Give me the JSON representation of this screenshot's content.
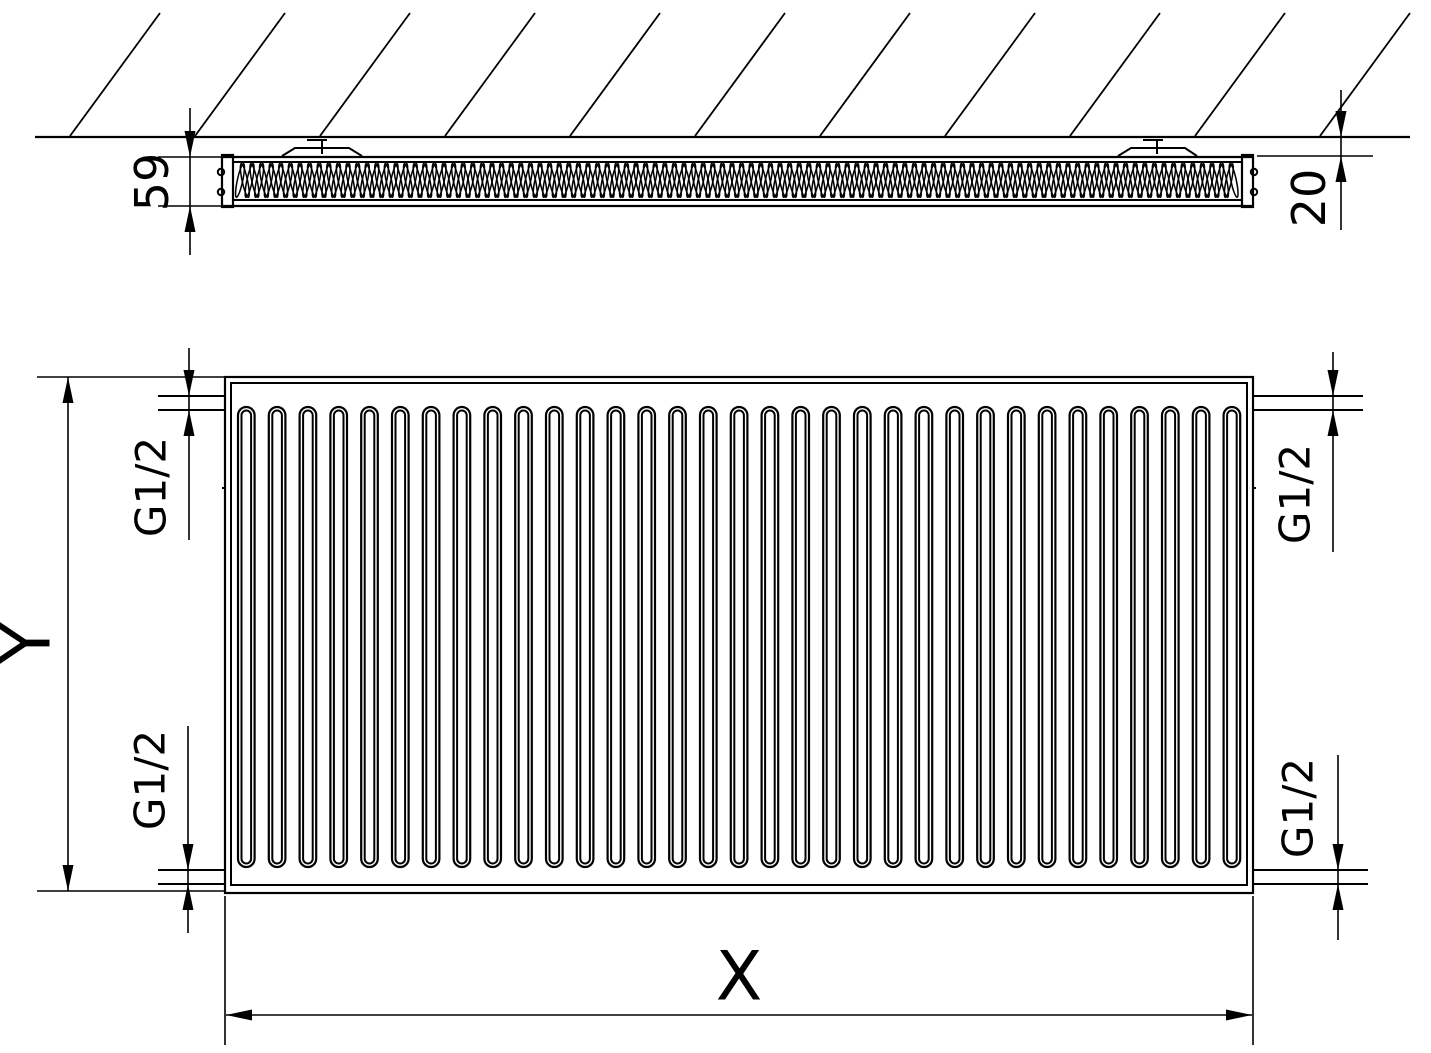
{
  "drawing": {
    "colors": {
      "line": "#000000",
      "background": "#ffffff"
    },
    "top_view": {
      "depth_label": "59",
      "wall_gap_label": "20"
    },
    "front_view": {
      "height_label": "Y",
      "width_label": "X",
      "connections": {
        "top_left": "G1/2",
        "top_right": "G1/2",
        "bottom_left": "G1/2",
        "bottom_right": "G1/2"
      }
    }
  }
}
